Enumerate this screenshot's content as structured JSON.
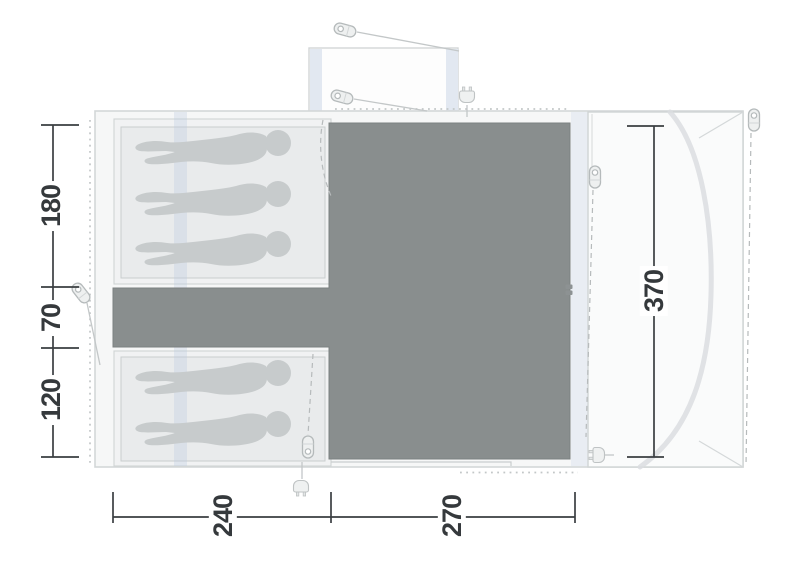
{
  "diagram": {
    "name": "tent floor plan",
    "dimension_labels": {
      "left": [
        "180",
        "70",
        "120"
      ],
      "bottom": [
        "240",
        "270"
      ],
      "right": [
        "370"
      ]
    },
    "sleeping": {
      "top_cabin_persons": 3,
      "bottom_cabin_persons": 2
    },
    "icon_counts": {
      "tent_pegs": 6,
      "power_plugs": 3,
      "zip_pulls": 2
    },
    "colors": {
      "living_area": "#898e8e",
      "cabin_mat": "#e9ebec",
      "person_silhouette": "#c7cbcc",
      "air_beam": "#dce4ee",
      "dimension_text": "#35393c"
    }
  }
}
